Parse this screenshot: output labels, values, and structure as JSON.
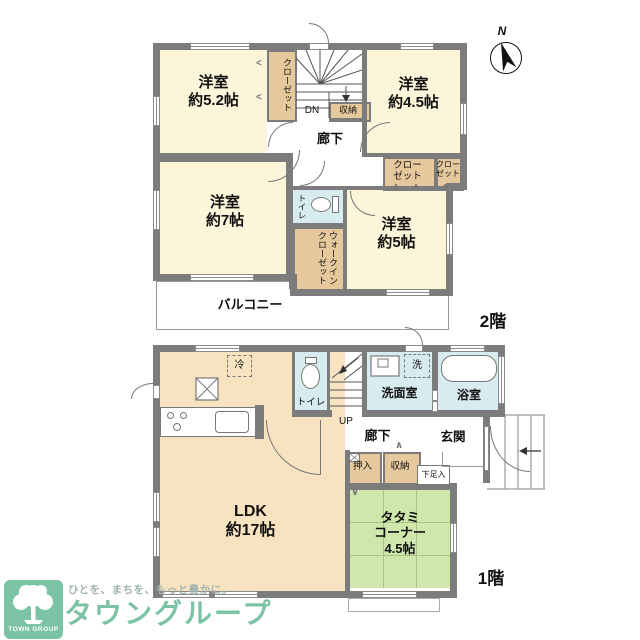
{
  "meta": {
    "floor1_label": "1階",
    "floor2_label": "2階",
    "north": "N",
    "stairs_down": "DN",
    "stairs_up": "UP",
    "marks": {
      "v": "∨",
      "caret": "∧",
      "left_caret": "<"
    }
  },
  "floor2": {
    "room52": {
      "name": "洋室",
      "size": "約5.2帖"
    },
    "room45": {
      "name": "洋室",
      "size": "約4.5帖"
    },
    "room7": {
      "name": "洋室",
      "size": "約7帖"
    },
    "room5": {
      "name": "洋室",
      "size": "約5帖"
    },
    "closet_vertical": "クローゼット",
    "closet_a_l1": "クロー",
    "closet_a_l2": "ゼット",
    "closet_b_l1": "クロー",
    "closet_b_l2": "ゼット",
    "storage": "収納",
    "hallway": "廊下",
    "toilet": "トイレ",
    "walk_in_closet": "ウォークインクローゼット",
    "balcony": "バルコニー"
  },
  "floor1": {
    "ldk_name": "LDK",
    "ldk_size": "約17帖",
    "tatami_l1": "タタミ",
    "tatami_l2": "コーナー",
    "tatami_l3": "4.5帖",
    "toilet": "トイレ",
    "washroom": "洗面室",
    "bath": "浴室",
    "entrance": "玄関",
    "hallway": "廊下",
    "oshiire": "押入",
    "storage": "収納",
    "shoe_box": "下足入",
    "fridge": "冷",
    "washer": "洗"
  },
  "logo": {
    "group": "TOWN GROUP",
    "tagline": "ひとを、まちを、もっと豊かに。",
    "name": "タウングループ"
  },
  "colors": {
    "wall": "#7c7c7c",
    "room_cream": "#FBF5D9",
    "ldk_peach": "#F8E3C0",
    "closet_tan": "#E5C89B",
    "wet_blue": "#D8ECF0",
    "tatami_green": "#CFE6AD",
    "logo_green": "#7CC3A5",
    "tagline_gray": "#9FB3AF"
  }
}
